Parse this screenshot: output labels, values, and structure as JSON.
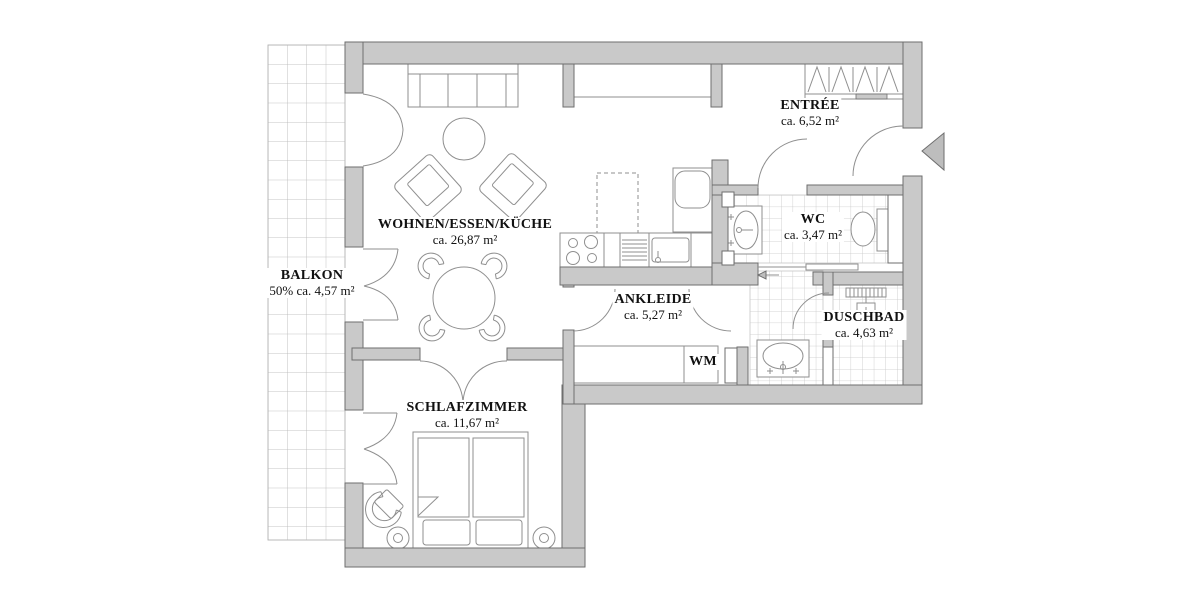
{
  "rooms": [
    {
      "id": "balkon",
      "name": "BALKON",
      "area": "50% ca. 4,57 m²"
    },
    {
      "id": "wohnen",
      "name": "WOHNEN/ESSEN/KÜCHE",
      "area": "ca. 26,87 m²"
    },
    {
      "id": "entree",
      "name": "ENTRÉE",
      "area": "ca. 6,52 m²"
    },
    {
      "id": "wc",
      "name": "WC",
      "area": "ca. 3,47 m²"
    },
    {
      "id": "ankleide",
      "name": "ANKLEIDE",
      "area": "ca. 5,27 m²"
    },
    {
      "id": "wm",
      "name": "WM",
      "area": ""
    },
    {
      "id": "duschbad",
      "name": "DUSCHBAD",
      "area": "ca. 4,63 m²"
    },
    {
      "id": "schlafzimmer",
      "name": "SCHLAFZIMMER",
      "area": "ca. 11,67 m²"
    }
  ],
  "colors": {
    "wall_fill": "#c9c9c9",
    "wall_edge": "#6e6e6e",
    "furniture_line": "#8f8f8f",
    "tile_line": "#c6c6c6",
    "balcony_grid": "#b3b3b3",
    "text": "#111111",
    "entrance_arrow_fill": "#bdbdbd"
  }
}
